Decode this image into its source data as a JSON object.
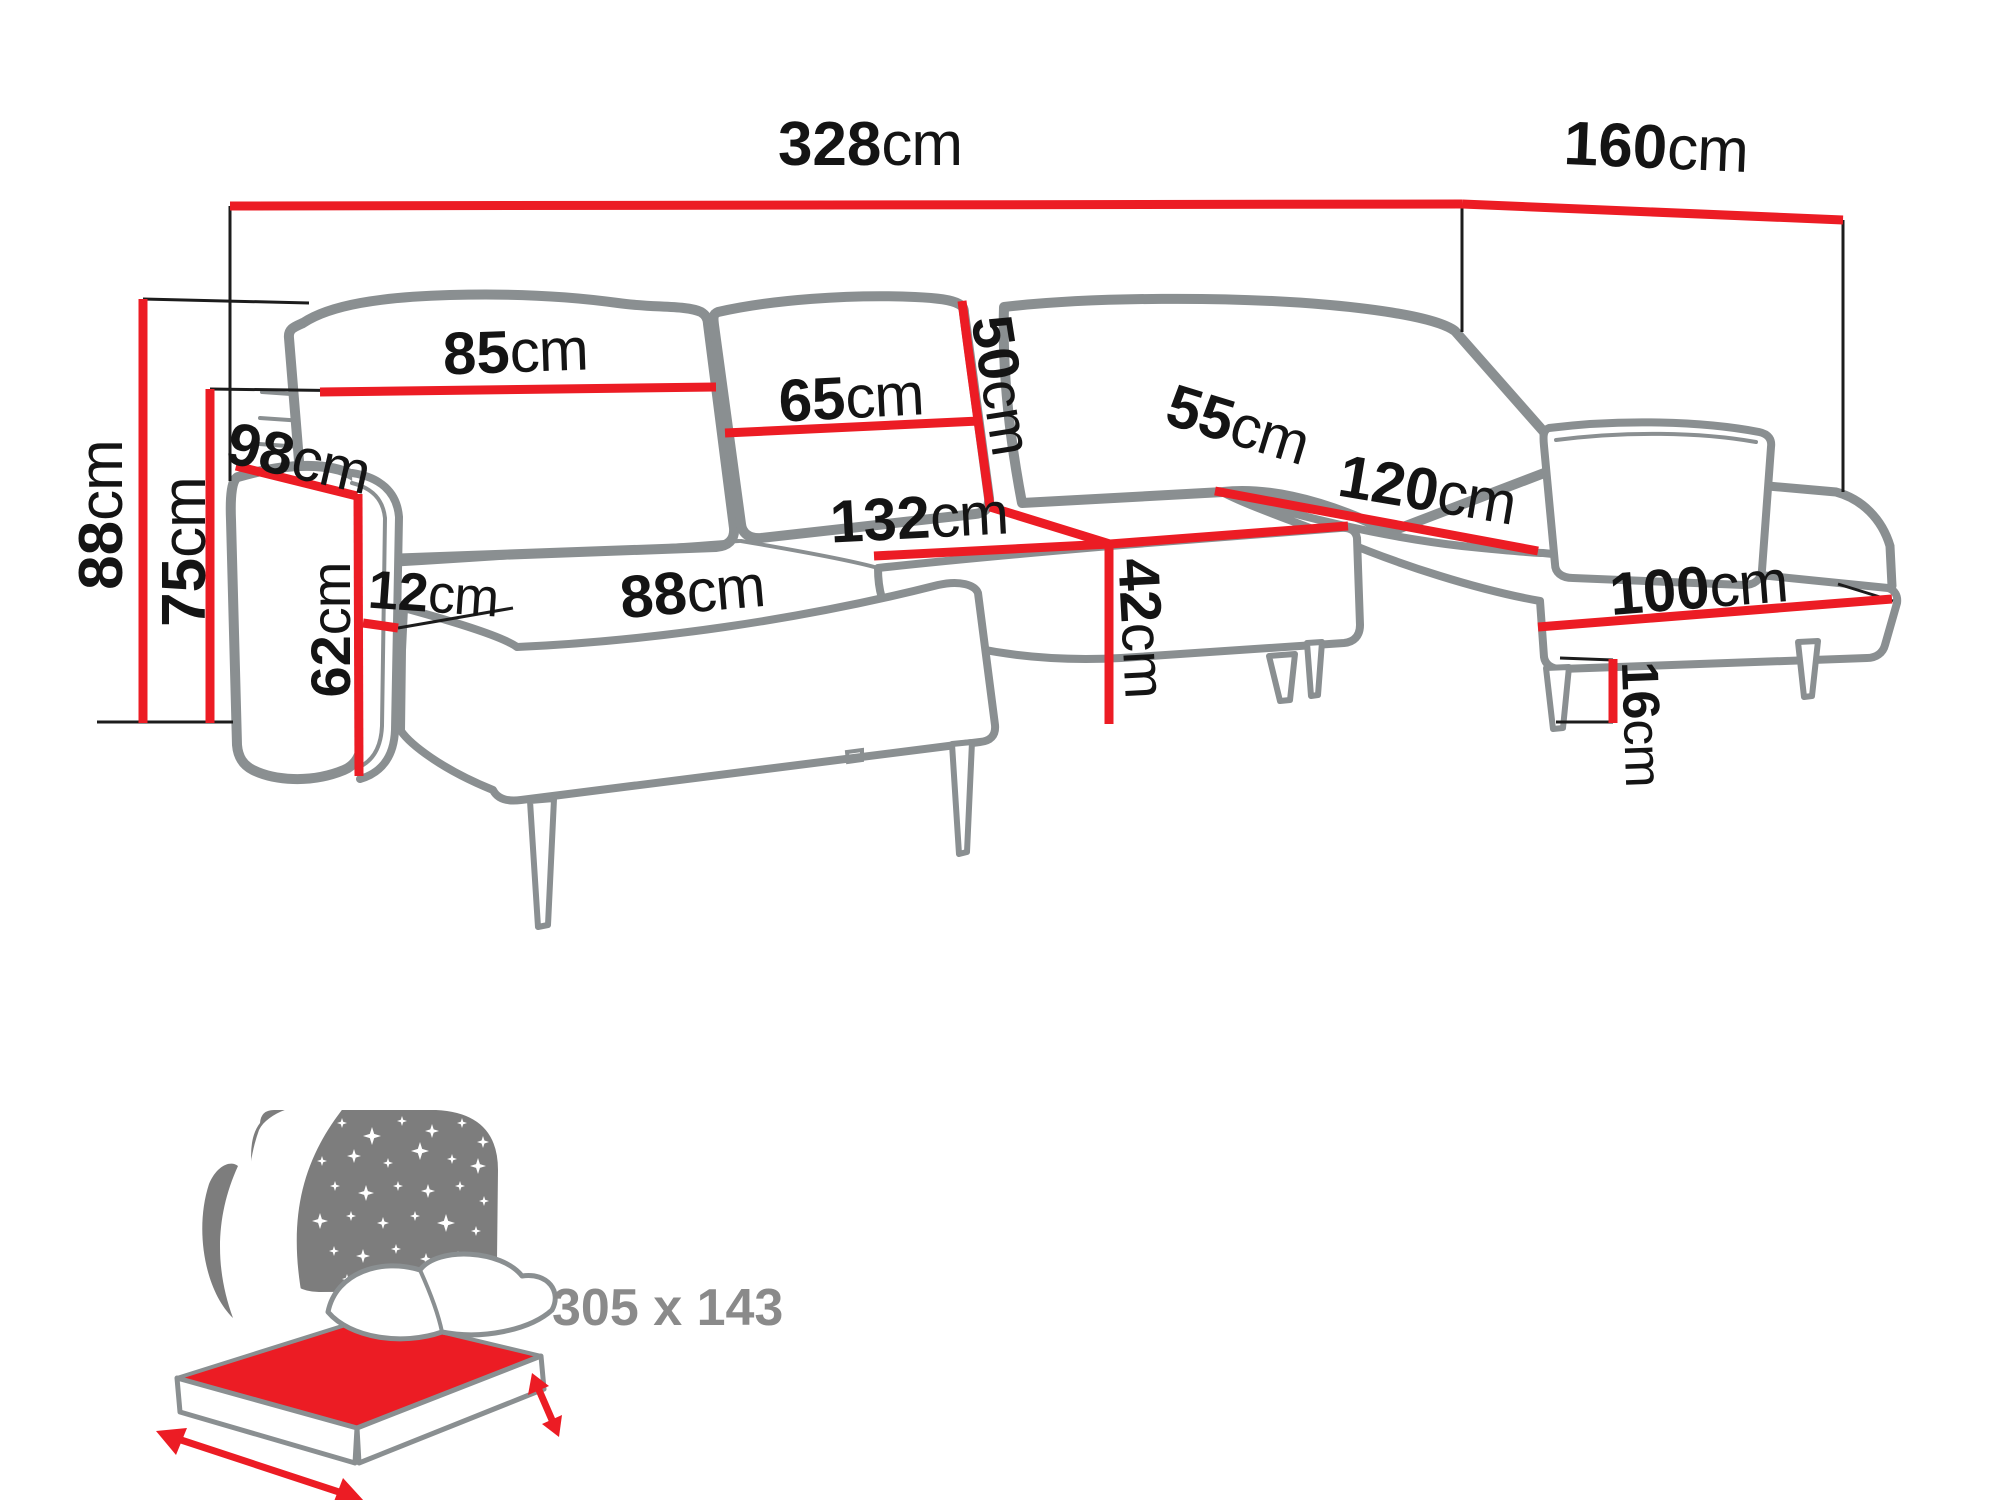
{
  "diagram": {
    "type": "sofa-dimension-diagram",
    "unit": "cm",
    "dimensions": {
      "overall_width": {
        "value": "328",
        "unit": "cm"
      },
      "overall_depth": {
        "value": "160",
        "unit": "cm"
      },
      "overall_height": {
        "value": "88",
        "unit": "cm"
      },
      "backrest_height": {
        "value": "75",
        "unit": "cm"
      },
      "armrest_depth": {
        "value": "98",
        "unit": "cm"
      },
      "armrest_height": {
        "value": "62",
        "unit": "cm"
      },
      "armrest_width": {
        "value": "12",
        "unit": "cm"
      },
      "left_back_cushion_width": {
        "value": "85",
        "unit": "cm"
      },
      "middle_back_cushion_width": {
        "value": "65",
        "unit": "cm"
      },
      "back_cushion_height": {
        "value": "50",
        "unit": "cm"
      },
      "middle_seat_depth": {
        "value": "55",
        "unit": "cm"
      },
      "middle_seat_width": {
        "value": "132",
        "unit": "cm"
      },
      "left_seat_width": {
        "value": "88",
        "unit": "cm"
      },
      "seat_height": {
        "value": "42",
        "unit": "cm"
      },
      "chaise_depth": {
        "value": "120",
        "unit": "cm"
      },
      "chaise_width": {
        "value": "100",
        "unit": "cm"
      },
      "leg_height": {
        "value": "16",
        "unit": "cm"
      }
    },
    "sleeping_area": {
      "label": "305 x 143"
    },
    "colors": {
      "dimension_line_red": "#ec1c24",
      "outline_gray": "#8a8f91",
      "label_black": "#141414",
      "icon_gray": "#7d7d7d"
    }
  }
}
